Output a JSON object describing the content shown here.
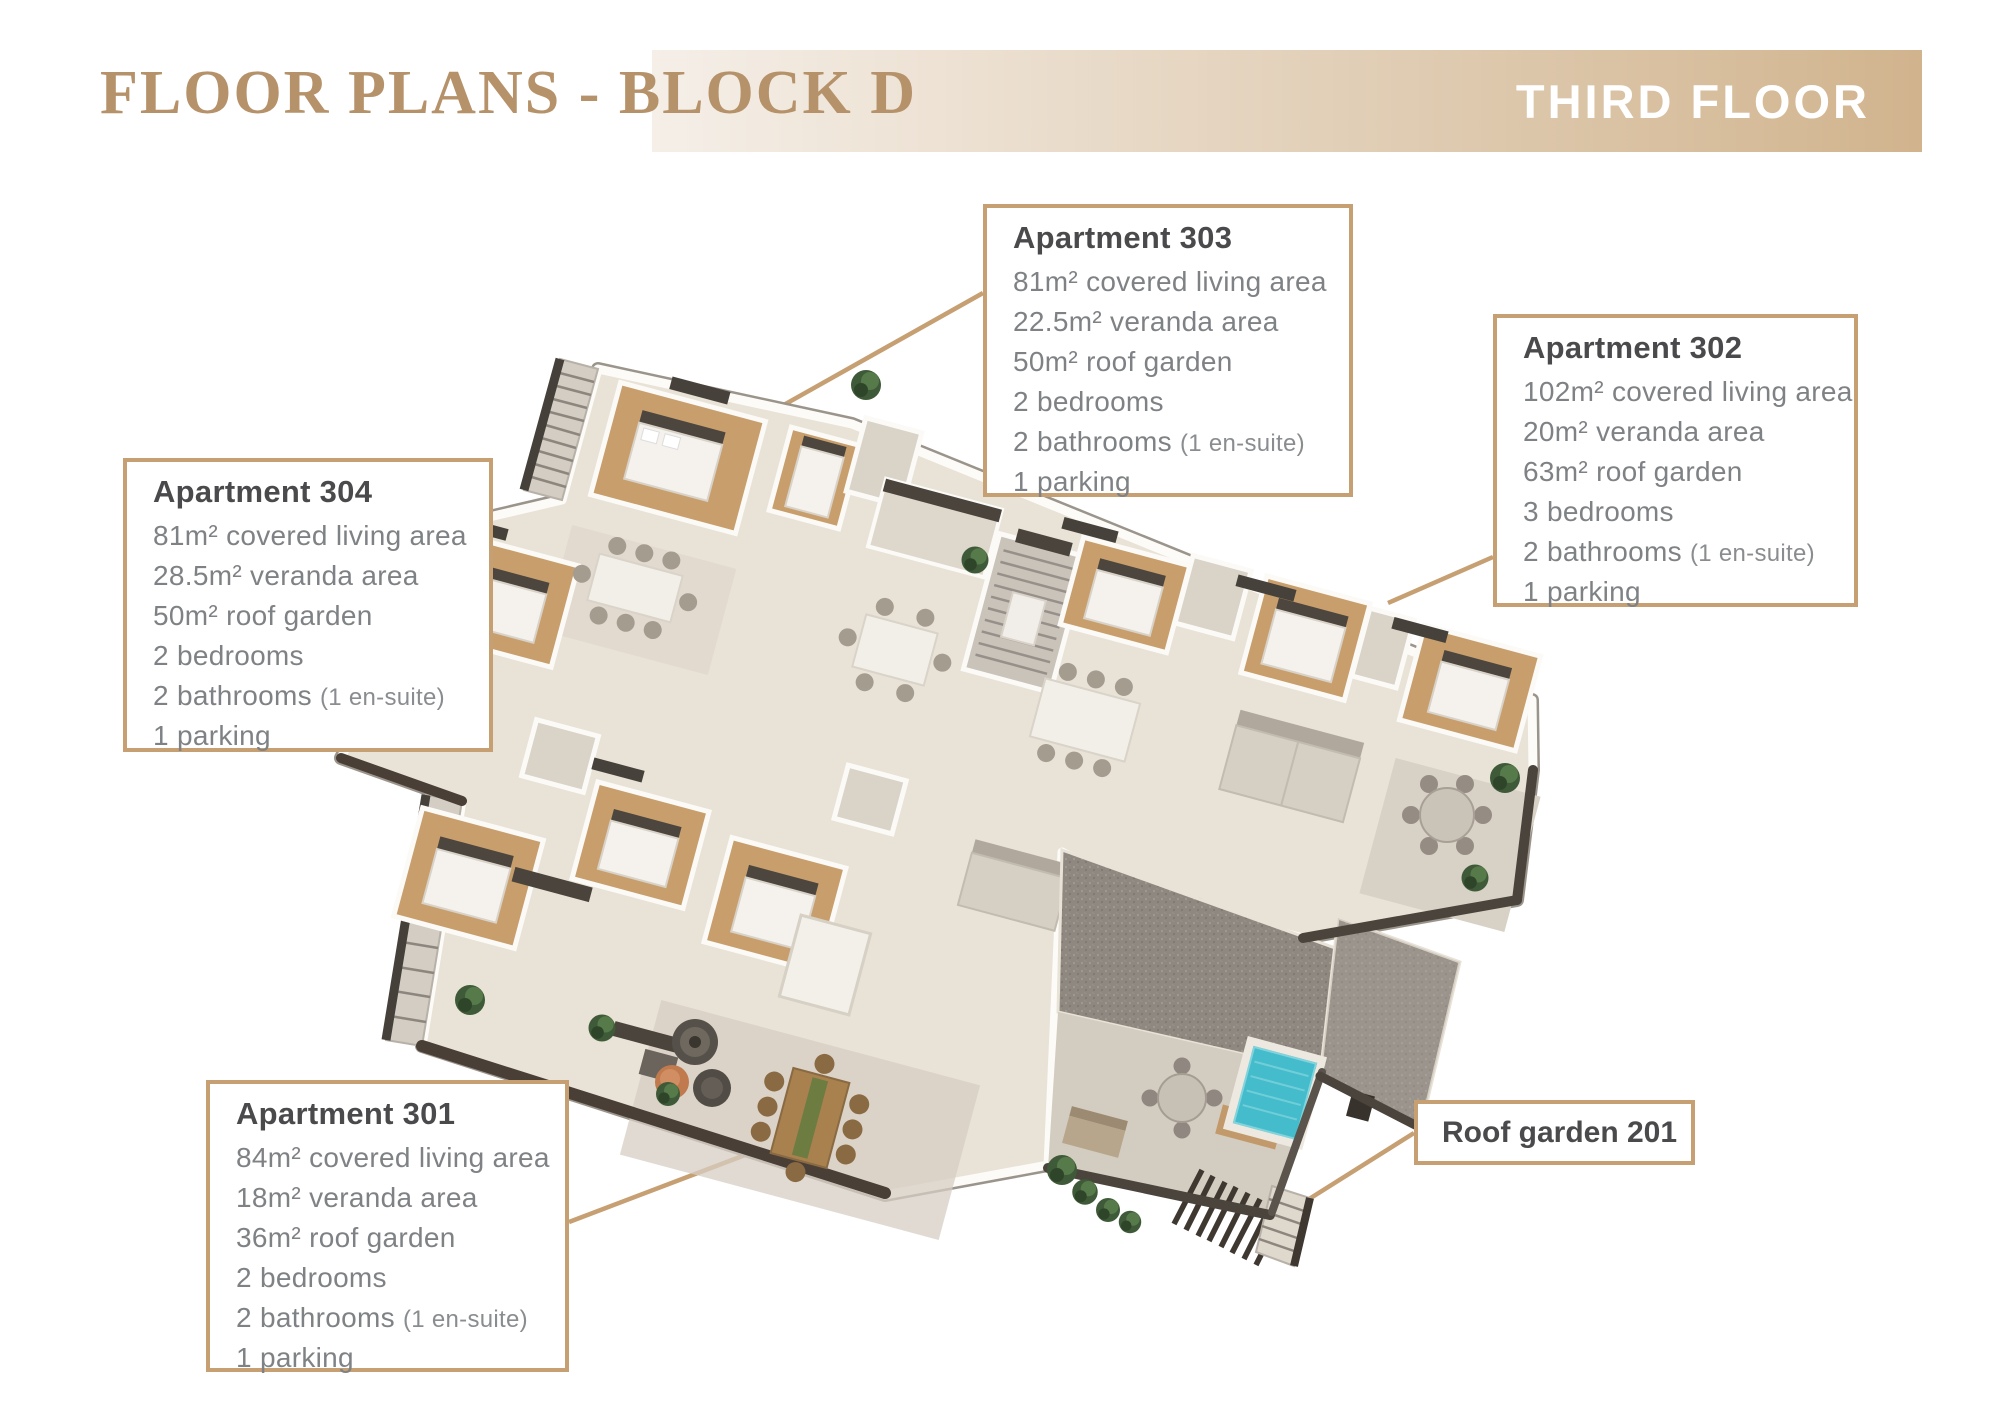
{
  "header": {
    "title": "FLOOR PLANS - BLOCK D",
    "floor_badge": "THIRD FLOOR"
  },
  "palette": {
    "accent": "#c69f72",
    "title-color": "#b6926a",
    "band-from": "#f5efe8",
    "band-to": "#d1b48e",
    "heading": "#4a4a4c",
    "body": "#7f8285",
    "note": "#8a8d90",
    "plan-floor": "#e9e2d6",
    "plan-wood": "#c89f6c",
    "plan-roof-gray": "#8f8881",
    "pool-water": "#45bccb",
    "plant-green": "#3f5a38",
    "parapet-dark": "#4a3f37"
  },
  "callouts": {
    "apt303": {
      "title": "Apartment 303",
      "covered": "81m² covered living area",
      "veranda": "22.5m² veranda area",
      "roof": "50m² roof garden",
      "bedrooms": "2 bedrooms",
      "bathrooms": "2 bathrooms",
      "bathrooms_note": "(1 en-suite)",
      "parking": "1 parking"
    },
    "apt302": {
      "title": "Apartment 302",
      "covered": "102m² covered living area",
      "veranda": "20m² veranda area",
      "roof": "63m² roof garden",
      "bedrooms": "3 bedrooms",
      "bathrooms": "2 bathrooms",
      "bathrooms_note": "(1 en-suite)",
      "parking": "1 parking"
    },
    "apt304": {
      "title": "Apartment 304",
      "covered": "81m² covered living area",
      "veranda": "28.5m² veranda area",
      "roof": "50m² roof garden",
      "bedrooms": "2 bedrooms",
      "bathrooms": "2 bathrooms",
      "bathrooms_note": "(1 en-suite)",
      "parking": "1 parking"
    },
    "apt301": {
      "title": "Apartment 301",
      "covered": "84m² covered living area",
      "veranda": "18m² veranda area",
      "roof": "36m² roof garden",
      "bedrooms": "2 bedrooms",
      "bathrooms": "2 bathrooms",
      "bathrooms_note": "(1 en-suite)",
      "parking": "1 parking"
    },
    "roof_garden": {
      "title": "Roof garden 201"
    }
  }
}
